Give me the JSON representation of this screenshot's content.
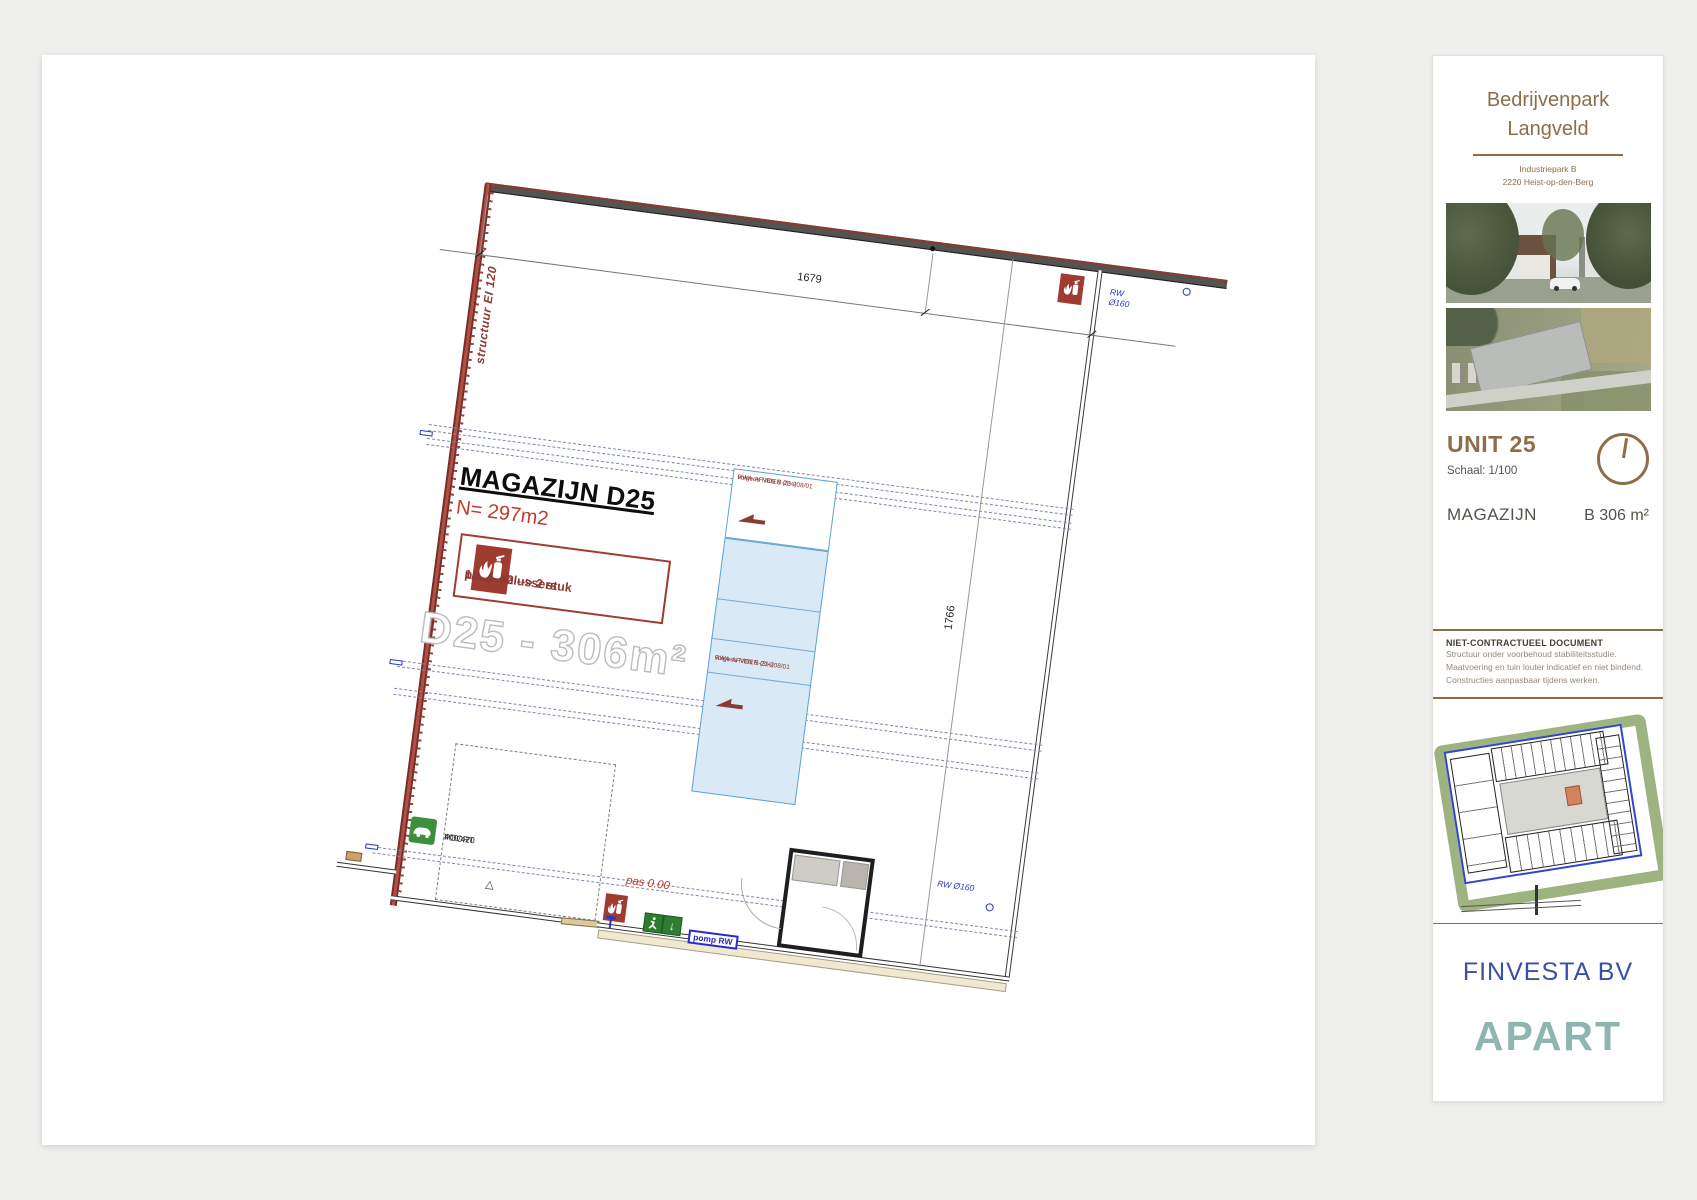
{
  "page": {
    "background": "#efefed"
  },
  "plan": {
    "unit_label": "MAGAZIJN D25",
    "area_label": "N= 297m2",
    "extinguisher_box": {
      "line1": "poederblussers",
      "line2": "1/150m2  --> 2 stuk"
    },
    "watermark": "D25 - 306m²",
    "rwa_top": {
      "line1": "RWA-AFVOER (3%)",
      "line2": "volgens NBN S-21-208/01"
    },
    "rwa_mid": {
      "line1": "RWA-AFVOER (3%)",
      "line2": "volgens NBN S-21-208/01"
    },
    "dim_width": "1679",
    "dim_height": "1766",
    "wall_label": "structuur EI 120",
    "gate": {
      "line1": "POORT",
      "line2": "400/420"
    },
    "gate_triangle": "△",
    "level_label": "pas 0.00",
    "pump_label": "pomp RW",
    "rw_top": "RW Ø160",
    "rw_bottom": "RW Ø160",
    "exit_arrow": "↓"
  },
  "sidebar": {
    "title_line1": "Bedrijvenpark",
    "title_line2": "Langveld",
    "address_line1": "Industriepark B",
    "address_line2": "2220 Heist-op-den-Berg",
    "unit_title": "UNIT 25",
    "scale": "Schaal: 1/100",
    "unit_type": "MAGAZIJN",
    "unit_area": "B 306 m²",
    "disclaimer_title": "NIET-CONTRACTUEEL DOCUMENT",
    "disclaimer_lines": [
      "Structuur onder voorbehoud stabiliteitsstudie.",
      "Maatvoering en tuin louter indicatief en niet bindend.",
      "Constructies aanpasbaar tijdens werken."
    ],
    "developer": "FINVESTA BV",
    "brand": "APART"
  },
  "colors": {
    "accent_brown": "#8c6e4a",
    "wall_red": "#9c4038",
    "annotation_red": "#c13a2e",
    "rwa_fill_blue": "#d9e9f6",
    "marker_blue": "#2936c4",
    "finvesta_blue": "#3b4ea8",
    "apart_teal": "#8fb5b0",
    "safety_red": "#a03b32",
    "safety_green": "#2e7d32",
    "ev_green": "#3d8f3d"
  },
  "icons": {
    "fire_extinguisher": "white extinguisher + flames on red square",
    "exit_sign": "running man + down arrow on green",
    "ev_charging": "white car on green square",
    "compass": "circle with north needle",
    "slope_arrow": "dark red wedge arrow"
  }
}
